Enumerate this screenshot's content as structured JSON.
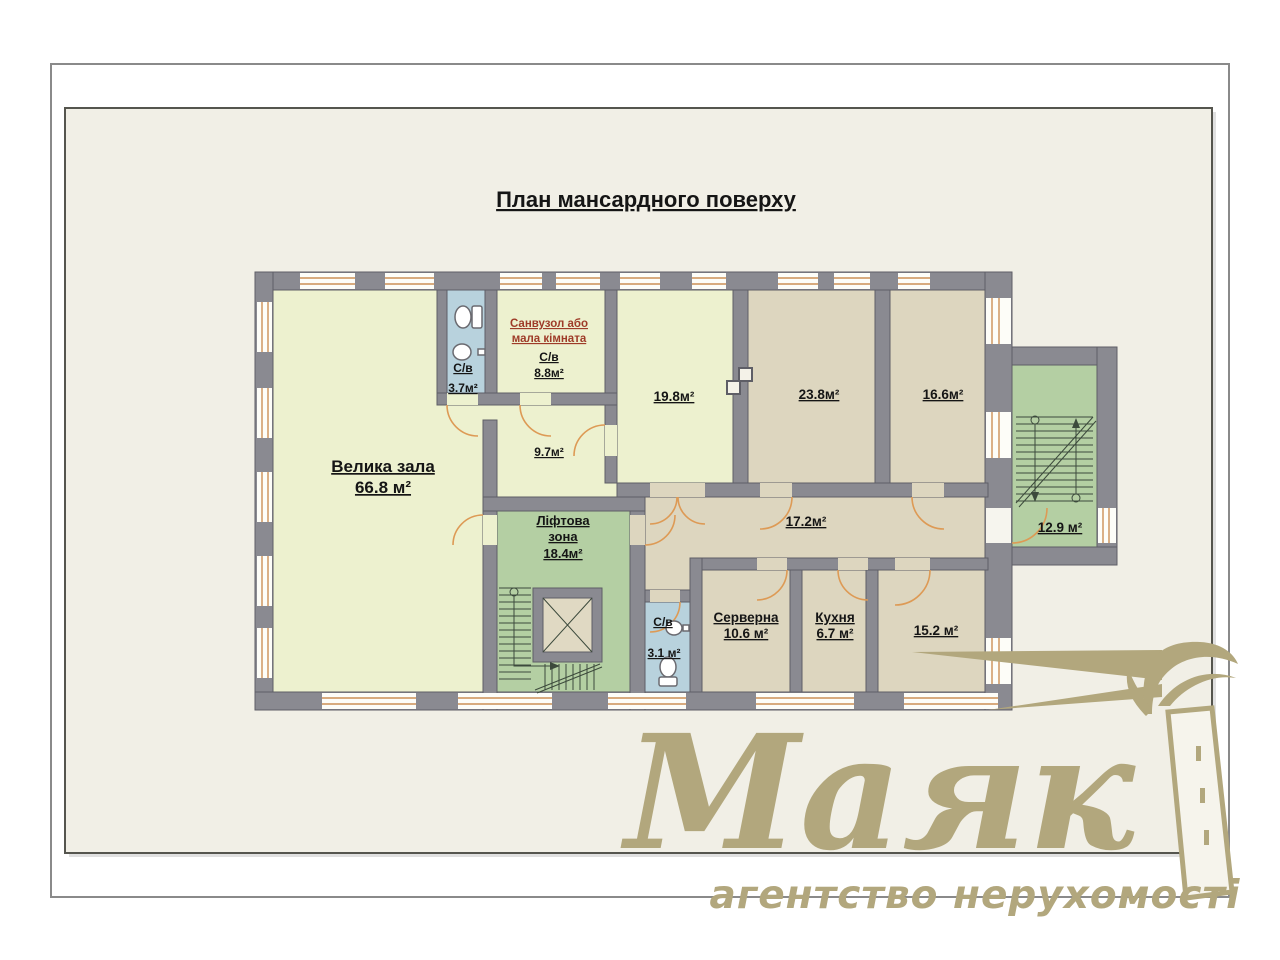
{
  "page": {
    "title": "План мансардного поверху"
  },
  "plan": {
    "rooms": {
      "hall": {
        "name": "Велика зала",
        "area": "66.8 м²"
      },
      "wc_top": {
        "name": "С/в",
        "area": "3.7м²"
      },
      "san": {
        "note1": "Санвузол або",
        "note2": "мала кімната",
        "name": "С/в",
        "area": "8.8м²"
      },
      "r97": {
        "area": "9.7м²"
      },
      "r198": {
        "area": "19.8м²"
      },
      "r238": {
        "area": "23.8м²"
      },
      "r166": {
        "area": "16.6м²"
      },
      "lift": {
        "name1": "Ліфтова",
        "name2": "зона",
        "area": "18.4м²"
      },
      "corridor": {
        "area": "17.2м²"
      },
      "wc_bottom": {
        "name": "С/в",
        "area": "3.1 м²"
      },
      "server": {
        "name": "Серверна",
        "area": "10.6 м²"
      },
      "kitchen": {
        "name": "Кухня",
        "area": "6.7 м²"
      },
      "r152": {
        "area": "15.2 м²"
      },
      "stairs": {
        "area": "12.9 м²"
      }
    }
  },
  "watermark": {
    "brand": "Маяк",
    "tagline": "агентство нерухомості"
  },
  "colors": {
    "paper": "#f1efe6",
    "room_light": "#edf1cf",
    "room_tan": "#ddd6bf",
    "room_green": "#b4cfa3",
    "room_blue": "#b8d2dd",
    "wall": "#8a8a91",
    "door_orange": "#dd9a55",
    "note_red": "#9e3b28",
    "watermark": "#b2a77d"
  }
}
